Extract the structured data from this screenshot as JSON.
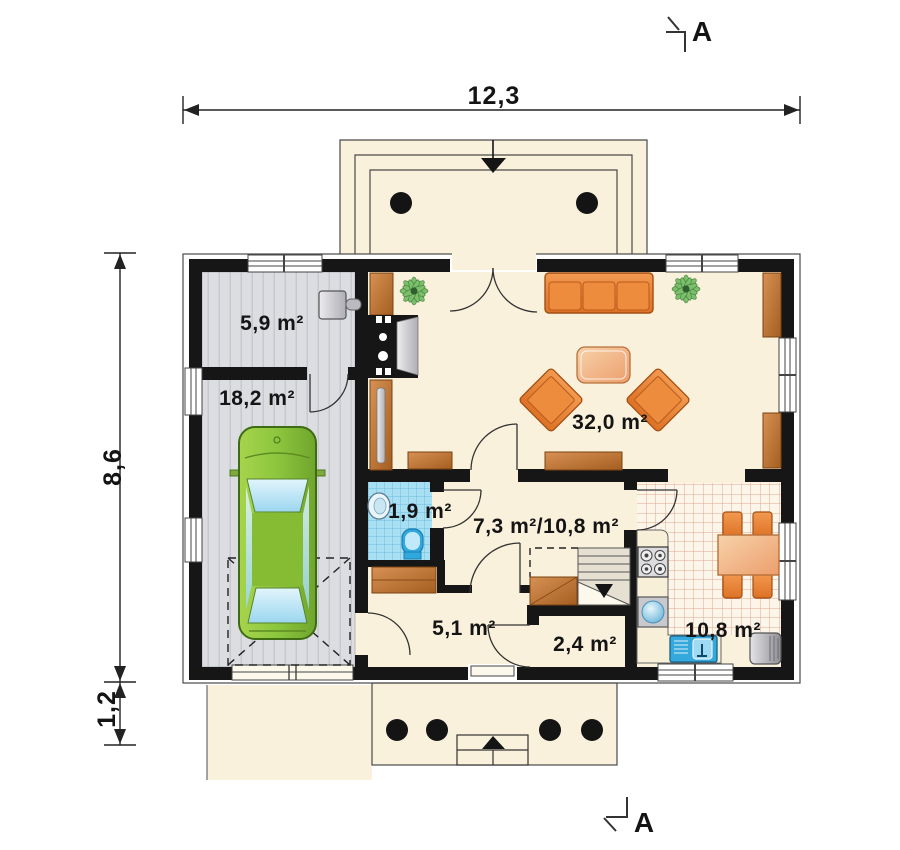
{
  "plan": {
    "title": "house-ground-floor-plan",
    "dimensions": {
      "top_width": "12,3",
      "left_height": "8,6",
      "porch_depth": "1,2"
    },
    "section_markers": {
      "top": "A",
      "bottom": "A"
    },
    "rooms": [
      {
        "id": "utility-room",
        "label": "5,9 m²"
      },
      {
        "id": "garage",
        "label": "18,2 m²"
      },
      {
        "id": "living-room",
        "label": "32,0 m²"
      },
      {
        "id": "wc",
        "label": "1,9 m²"
      },
      {
        "id": "hall",
        "label": "7,3 m²/10,8 m²"
      },
      {
        "id": "corridor",
        "label": "5,1 m²"
      },
      {
        "id": "pantry",
        "label": "2,4 m²"
      },
      {
        "id": "kitchen",
        "label": "10,8 m²"
      }
    ],
    "colors": {
      "wall": "#161616",
      "floor_cream": "#FAF1DC",
      "garage_gray": "#DBDDE1",
      "tile_blue": "#A8DFF3",
      "kitchen_grid": "#DFA183",
      "furniture_orange": "#E8823C",
      "wood": "#C07A36",
      "car_green": "#8CC63E"
    }
  }
}
